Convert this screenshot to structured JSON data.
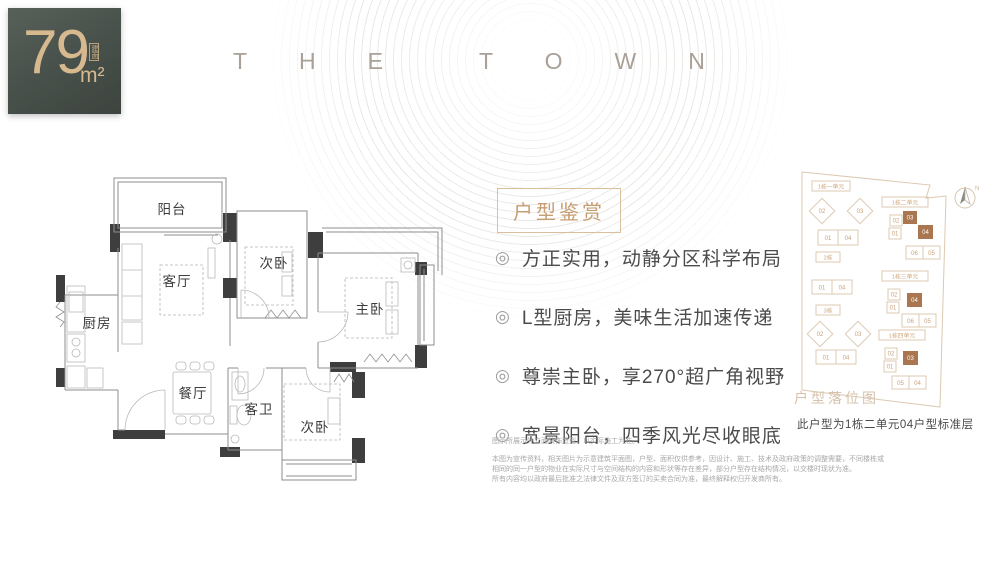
{
  "badge": {
    "value": "79",
    "unit": "m²",
    "label": "建面"
  },
  "brand": {
    "word1": "THE",
    "word2": "TOWN"
  },
  "floorplan": {
    "rooms": {
      "balcony": "阳台",
      "living": "客厅",
      "bedroom_top": "次卧",
      "master": "主卧",
      "kitchen": "厨房",
      "dining": "餐厅",
      "bath": "客卫",
      "bedroom_bottom": "次卧"
    }
  },
  "features": {
    "title": "户型鉴赏",
    "marker": "◎",
    "items": [
      "方正实用，动静分区科学布局",
      "L型厨房，美味生活加速传递",
      "尊崇主卧，享270°超广角视野",
      "宽景阳台，四季风光尽收眼底"
    ]
  },
  "siteplan": {
    "watermark": "户型落位图",
    "caption": "此户型为1栋二单元04户型标准层",
    "compass": "N",
    "clusters": {
      "l1": {
        "label": "1栋一单元",
        "d02": "02",
        "d03": "03",
        "r01": "01",
        "r04": "04"
      },
      "l2": {
        "label": "2栋",
        "r01": "01",
        "r04": "04"
      },
      "l3": {
        "label": "3栋",
        "d02": "02",
        "d03": "03",
        "r01": "01",
        "r04": "04"
      },
      "r1": {
        "label": "1栋二单元",
        "u02": "02",
        "u01": "01",
        "h03": "03",
        "h04": "04",
        "u06": "06",
        "u05": "05"
      },
      "r2": {
        "label": "1栋三单元",
        "u02": "02",
        "u01": "01",
        "h04": "04",
        "u06": "06",
        "u05": "05"
      },
      "r3": {
        "label": "1栋四单元",
        "u02": "02",
        "u01": "01",
        "h03": "03",
        "u05": "05",
        "u04": "04"
      }
    }
  },
  "disclaimer": {
    "line1": "图示所展示外立面装饰造型，以实际施工为准。",
    "para1": "本图为宣传资料，相关图片为示意建筑平面图，户型、面积仅供参考，因设计、施工、技术及政府政策的调整需要，不同楼栋或相同的同一户型的物业在实际尺寸与空间结构的内容和形状等存在差异，部分户型存在结构情况，以交楼时现状为准。",
    "para2": "所有内容均以政府最后批准之法律文件及双方签订的买卖合同为准，最终解释权归开发商所有。"
  },
  "colors": {
    "badge_bg": "#49524c",
    "gold": "#d6b98e",
    "accent_tan": "#c69e72",
    "site_outline": "#dcc9b2",
    "site_highlight": "#a9764f",
    "wall": "#3e3e3e",
    "text_dark": "#4b4b4b"
  }
}
